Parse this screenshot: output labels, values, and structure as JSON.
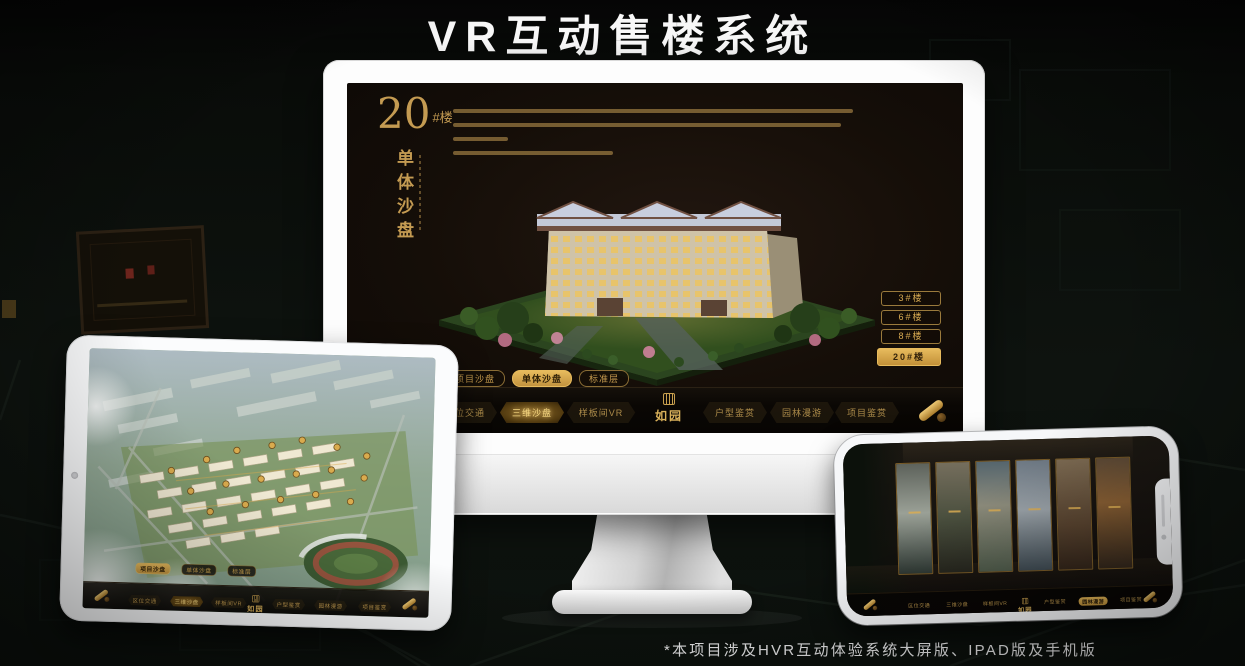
{
  "page": {
    "title": "VR互动售楼系统",
    "footnote": "*本项目涉及HVR互动体验系统大屏版、IPAD版及手机版"
  },
  "colors": {
    "gold_accent": "#c79c4e",
    "gold_active": "#d9ab52",
    "screen_background": "#140e08",
    "navbar_background": "#0a0704"
  },
  "monitor": {
    "building_title": {
      "number": "20",
      "suffix": "#楼",
      "vertical_label": "单体沙盘"
    },
    "floor_buttons": [
      {
        "label": "3#楼",
        "active": false
      },
      {
        "label": "6#楼",
        "active": false
      },
      {
        "label": "8#楼",
        "active": false
      },
      {
        "label": "20#楼",
        "active": true
      }
    ],
    "sub_tabs": [
      {
        "label": "项目沙盘",
        "active": false
      },
      {
        "label": "单体沙盘",
        "active": true
      },
      {
        "label": "标准层",
        "active": false
      }
    ],
    "logo": "如园",
    "nav_items": [
      {
        "label": "区位交通",
        "active": false
      },
      {
        "label": "三维沙盘",
        "active": true
      },
      {
        "label": "样板间VR",
        "active": false
      },
      {
        "label": "户型鉴赏",
        "active": false
      },
      {
        "label": "园林漫游",
        "active": false
      },
      {
        "label": "项目鉴赏",
        "active": false
      }
    ]
  },
  "tablet": {
    "sub_tabs": [
      {
        "label": "项目沙盘",
        "active": true
      },
      {
        "label": "单体沙盘",
        "active": false
      },
      {
        "label": "标准层",
        "active": false
      }
    ],
    "logo": "如园",
    "nav_items": [
      {
        "label": "区位交通",
        "active": false
      },
      {
        "label": "三维沙盘",
        "active": true
      },
      {
        "label": "样板间VR",
        "active": false
      },
      {
        "label": "户型鉴赏",
        "active": false
      },
      {
        "label": "园林漫游",
        "active": false
      },
      {
        "label": "项目鉴赏",
        "active": false
      }
    ]
  },
  "phone": {
    "logo": "如园",
    "nav_items": [
      {
        "label": "区位交通",
        "active": false
      },
      {
        "label": "三维沙盘",
        "active": false
      },
      {
        "label": "样板间VR",
        "active": false
      },
      {
        "label": "户型鉴赏",
        "active": false
      },
      {
        "label": "园林漫游",
        "active": true
      },
      {
        "label": "项目鉴赏",
        "active": false
      }
    ]
  }
}
